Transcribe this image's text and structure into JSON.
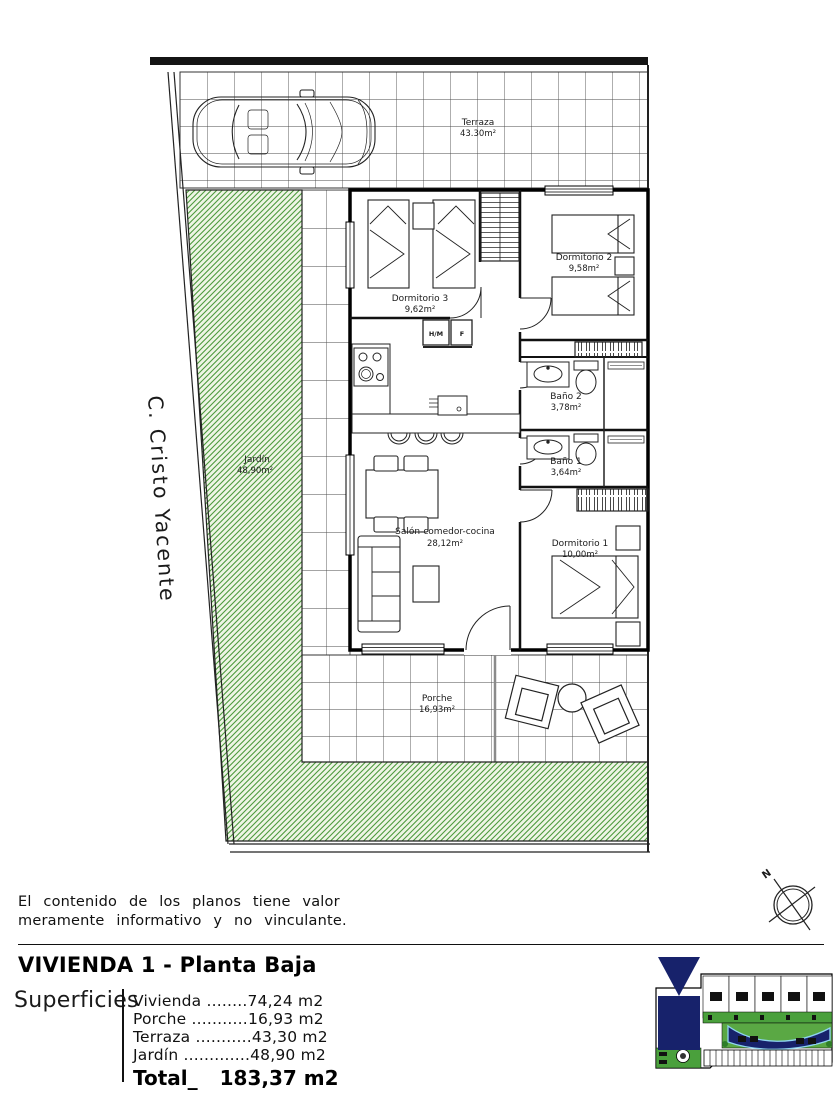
{
  "plan": {
    "street_label": "C. Cristo Yacente",
    "compass_label": "N",
    "labels": {
      "terraza_name": "Terraza",
      "terraza_area": "43.30m²",
      "dorm3_name": "Dormitorio 3",
      "dorm3_area": "9,62m²",
      "dorm2_name": "Dormitorio 2",
      "dorm2_area": "9,58m²",
      "bano2_name": "Baño 2",
      "bano2_area": "3,78m²",
      "bano1_name": "Baño 1",
      "bano1_area": "3,64m²",
      "dorm1_name": "Dormitorio 1",
      "dorm1_area": "10,00m²",
      "salon_name": "Salón-comedor-cocina",
      "salon_area": "28,12m²",
      "porche_name": "Porche",
      "porche_area": "16,93m²",
      "jardin_name": "Jardín",
      "jardin_area": "48,90m²",
      "appliance_hm": "H/M",
      "appliance_f": "F"
    }
  },
  "disclaimer": {
    "line1": "El contenido de los planos tiene valor",
    "line2": "meramente informativo y no vinculante."
  },
  "titleblock": {
    "title": "VIVIENDA 1 - Planta Baja",
    "surfaces_label": "Superficies",
    "rows": [
      {
        "label": "Vivienda ",
        "leader": "........",
        "value": "74,24 m2"
      },
      {
        "label": "Porche ",
        "leader": "...........",
        "value": "16,93 m2"
      },
      {
        "label": "Terraza ",
        "leader": "...........",
        "value": "43,30 m2"
      },
      {
        "label": "Jardín ",
        "leader": ".............",
        "value": "48,90 m2"
      }
    ],
    "total_label": "Total_",
    "total_value": "183,37 m2"
  },
  "colors": {
    "garden_hatch": "#4d9a3d",
    "garden_bg": "#eef5e5",
    "navy": "#17226b",
    "pool_edge": "#8fd4f0",
    "line": "#1a1a1a"
  }
}
